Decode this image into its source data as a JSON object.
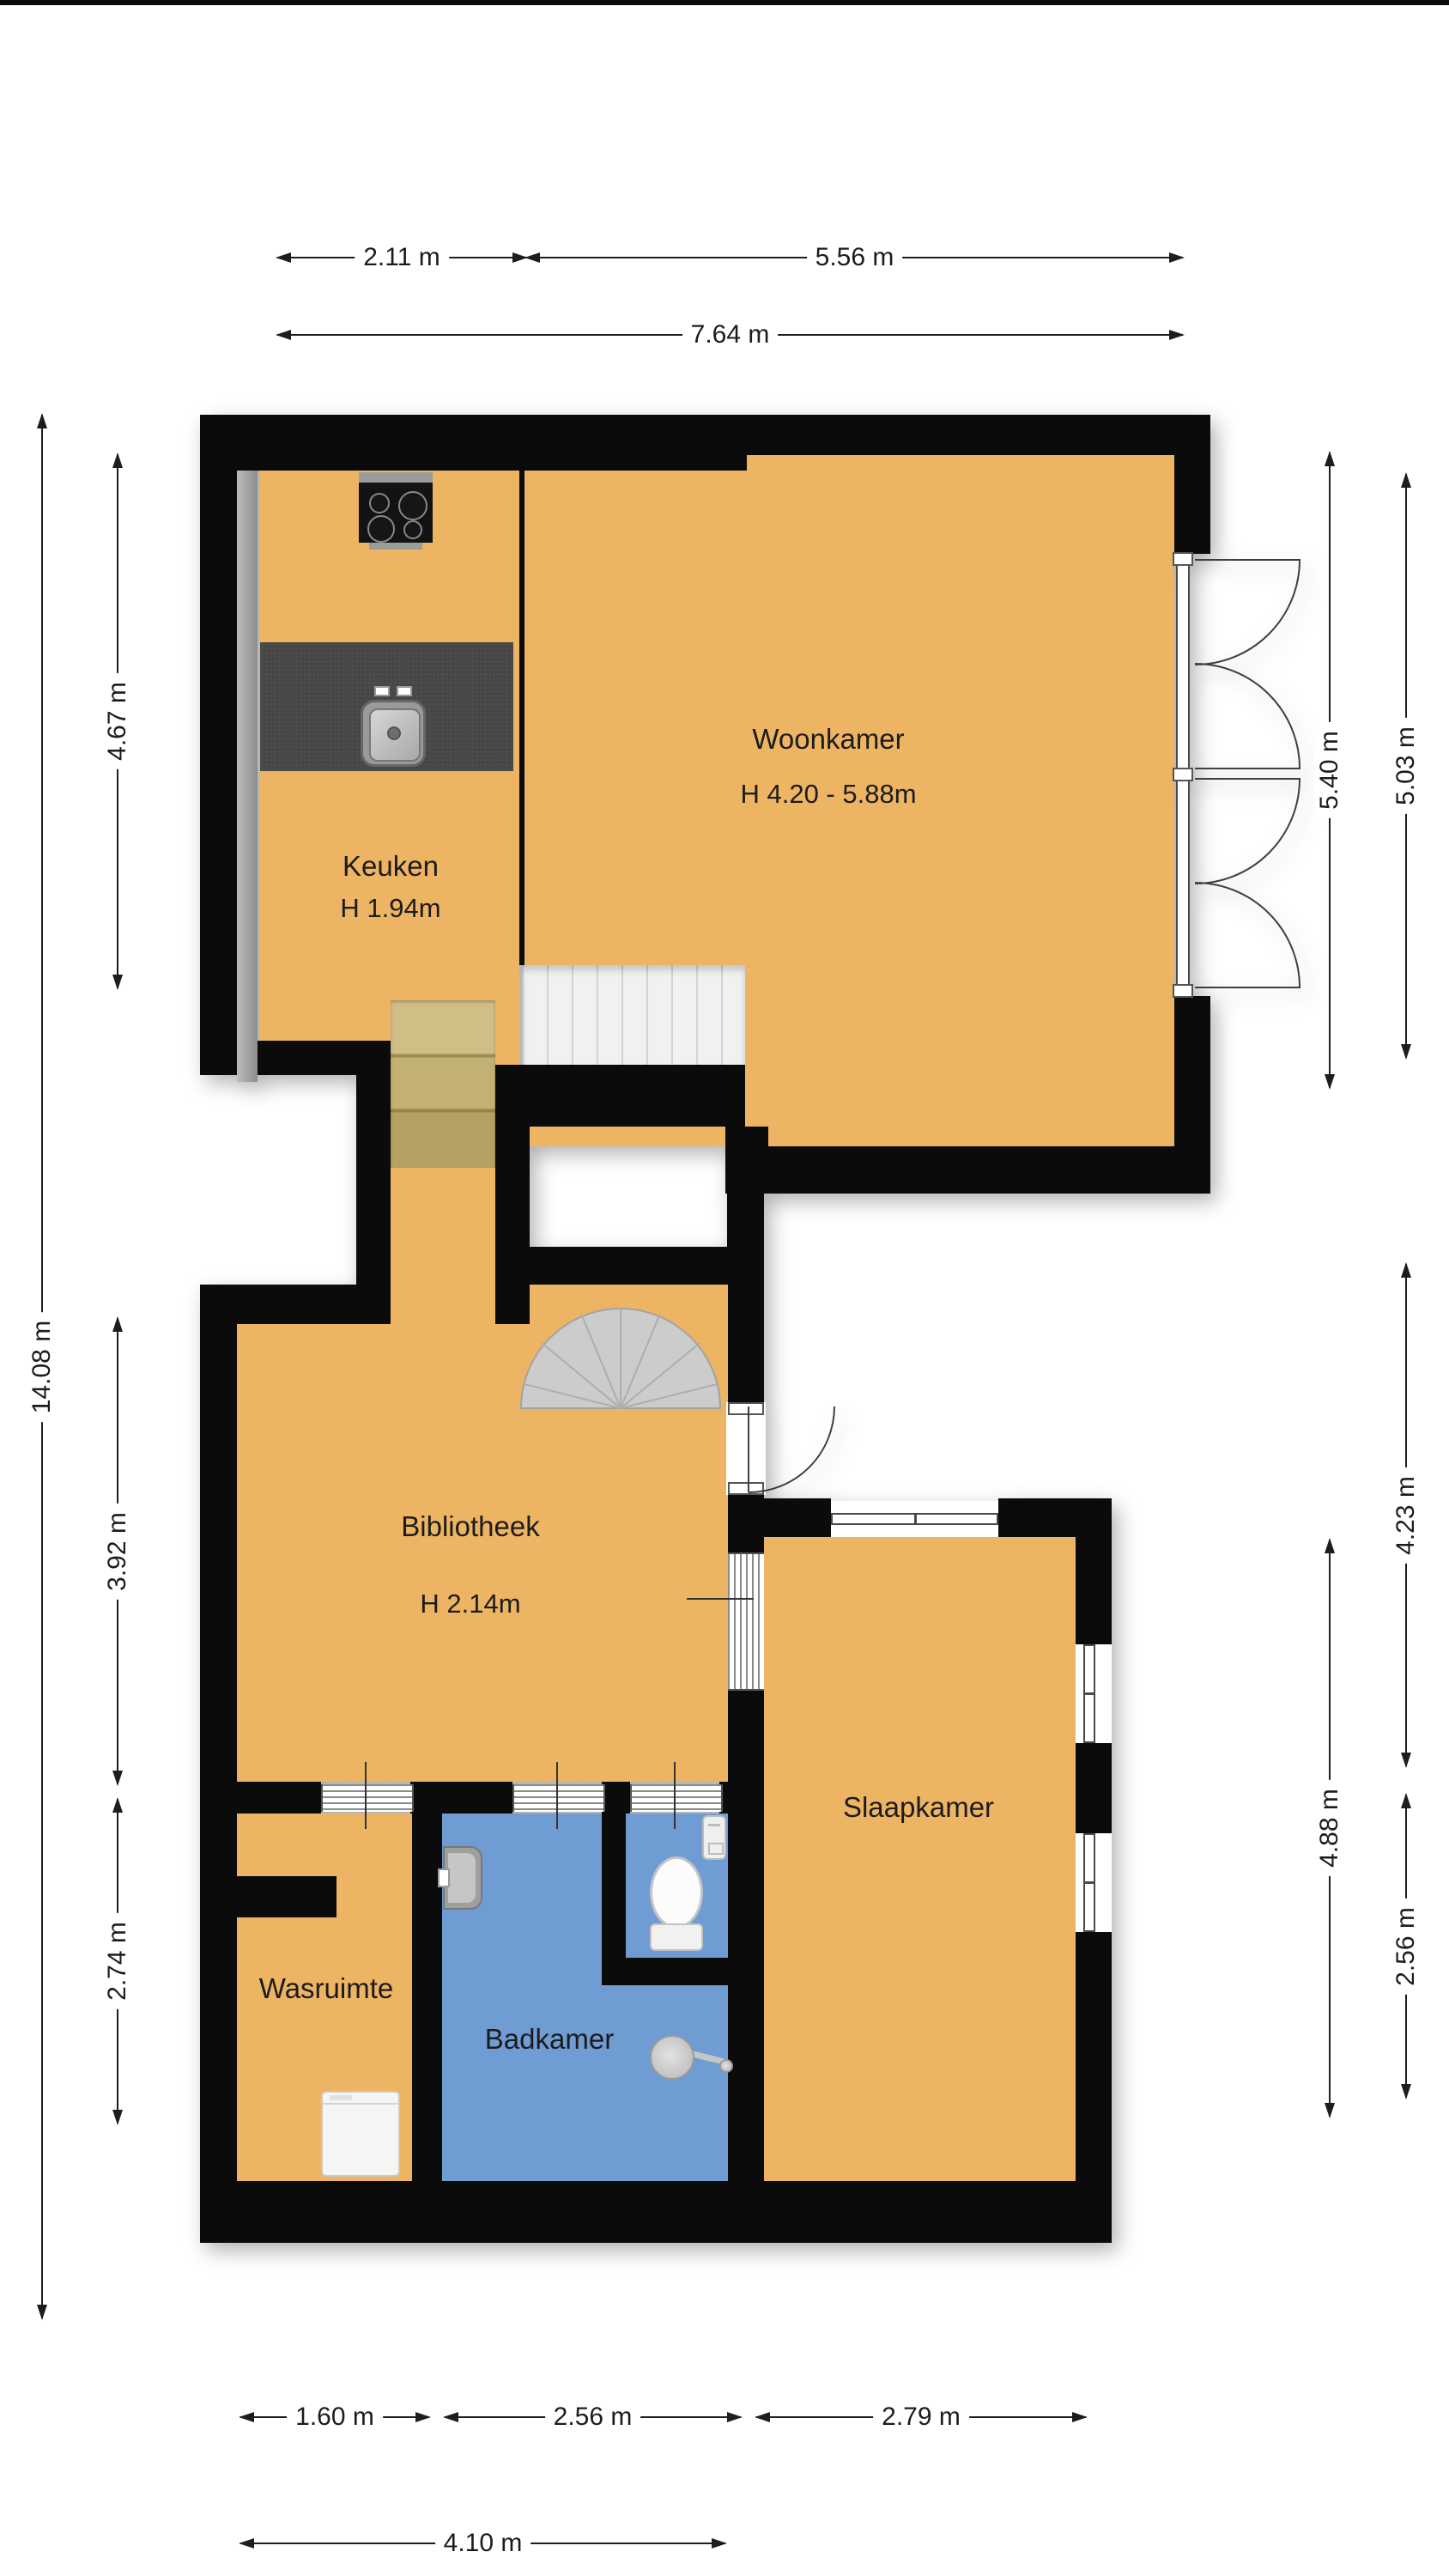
{
  "plan": {
    "type": "floorplan",
    "language": "nl",
    "rooms": [
      {
        "id": "woonkamer",
        "name": "Woonkamer",
        "height_label": "H 4.20 - 5.88m"
      },
      {
        "id": "keuken",
        "name": "Keuken",
        "height_label": "H 1.94m"
      },
      {
        "id": "bibliotheek",
        "name": "Bibliotheek",
        "height_label": "H 2.14m"
      },
      {
        "id": "slaapkamer",
        "name": "Slaapkamer"
      },
      {
        "id": "wasruimte",
        "name": "Wasruimte"
      },
      {
        "id": "badkamer",
        "name": "Badkamer"
      }
    ],
    "dimensions": {
      "top": [
        {
          "label": "2.11 m"
        },
        {
          "label": "5.56 m"
        },
        {
          "label": "7.64 m"
        }
      ],
      "left": [
        {
          "label": "14.08 m"
        },
        {
          "label": "4.67 m"
        },
        {
          "label": "3.92 m"
        },
        {
          "label": "2.74 m"
        }
      ],
      "right": [
        {
          "label": "5.40 m"
        },
        {
          "label": "5.03 m"
        },
        {
          "label": "4.23 m"
        },
        {
          "label": "4.88 m"
        },
        {
          "label": "2.56 m"
        }
      ],
      "bottom": [
        {
          "label": "1.60 m"
        },
        {
          "label": "2.56 m"
        },
        {
          "label": "2.79 m"
        },
        {
          "label": "4.10 m"
        }
      ]
    },
    "colors": {
      "floor": "#edb464",
      "bathroom_floor": "#6f9cd2",
      "wall": "#0b0b0b",
      "counter": "#474747",
      "wood_steps": "#c3b174",
      "stair_tread": "#f1f1f1",
      "spiral_stair": "#cccccc"
    },
    "fixtures": [
      "stove-icon",
      "kitchen-sink-icon",
      "counter",
      "straight-stairs",
      "wood-steps",
      "spiral-stairs",
      "french-doors",
      "interior-door",
      "washing-machine-icon",
      "bathroom-sink-icon",
      "toilet-icon",
      "cistern-icon",
      "shower-icon"
    ]
  }
}
